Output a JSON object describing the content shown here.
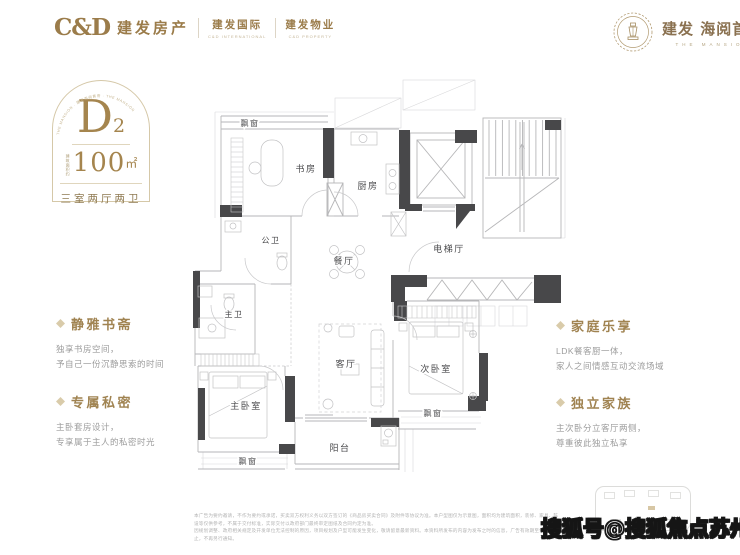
{
  "colors": {
    "gold": "#a5854e",
    "wall_dark": "#48484a",
    "line": "#b6b6b8"
  },
  "header": {
    "logo_cd": "C&D",
    "brand_main": "建发房产",
    "brand_intl": "建发国际",
    "brand_intl_sub": "C&D INTERNATIONAL",
    "brand_prop": "建发物业",
    "brand_prop_sub": "C&D PROPERTY",
    "project_brand": "建发",
    "project_name": "海阅首府",
    "project_sub": "THE MANSION"
  },
  "badge": {
    "arc_text": "THE MANSION · 建发海阅首府 · THE MANSION",
    "unit": "D",
    "unit_sub": "2",
    "area_prefix": "建筑面积约",
    "area_value": "100",
    "area_unit": "㎡",
    "layout": "三室两厅两卫"
  },
  "features_left": [
    {
      "title": "静雅书斋",
      "lines": [
        "独享书房空间，",
        "予自己一份沉静思索的时间"
      ]
    },
    {
      "title": "专属私密",
      "lines": [
        "主卧套房设计，",
        "专享属于主人的私密时光"
      ]
    }
  ],
  "features_right": [
    {
      "title": "家庭乐享",
      "lines": [
        "LDK餐客厨一体，",
        "家人之间情感互动交流场域"
      ]
    },
    {
      "title": "独立家族",
      "lines": [
        "主次卧分立客厅两侧，",
        "尊重彼此独立私享"
      ]
    }
  ],
  "floorplan": {
    "rooms": [
      {
        "label": "飘窗"
      },
      {
        "label": "书房"
      },
      {
        "label": "厨房"
      },
      {
        "label": "公卫"
      },
      {
        "label": "餐厅"
      },
      {
        "label": "电梯厅"
      },
      {
        "label": "主卫"
      },
      {
        "label": "客厅"
      },
      {
        "label": "次卧室"
      },
      {
        "label": "主卧室"
      },
      {
        "label": "阳台"
      },
      {
        "label": "飘窗"
      },
      {
        "label": "飘窗"
      }
    ]
  },
  "footer": {
    "disclaimer_line1": "本广告为要约邀请，不作为要约或承诺，买卖双方权利义务以双方签订的《商品房买卖合同》及附件等协议为准。本户型图仅为示意图，面积均为建筑面积，装修、家具、陈设等仅供参考，不属于交付标准，实际交付以政府部门最终审定图纸及合同约定为准。",
    "disclaimer_line2": "因规划调整、政府相关规定及开发单位无法控制的原因，项目规划及户型可能发生变化，敬请留意最新资料。本资料所发布的内容为发布之时的信息，广告有效期至售罄之日止，不再另行通知。"
  },
  "watermark": "搜狐号@搜狐焦点苏州站"
}
